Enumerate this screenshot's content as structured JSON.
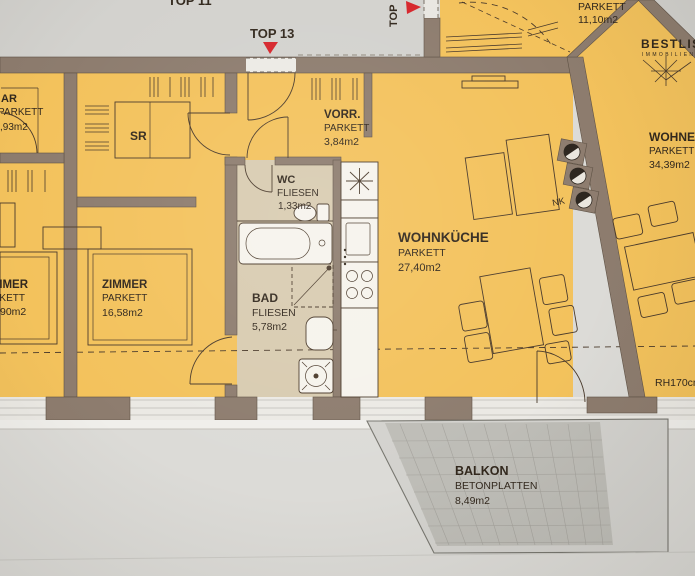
{
  "watermark": {
    "brand": "BESTLIST",
    "sub": "IMMOBILIEN"
  },
  "corridor": {
    "top11": "TOP 11",
    "top13": "TOP 13",
    "top_side": "TOP"
  },
  "rooms": {
    "ar": {
      "name": "AR",
      "floor": "PARKETT",
      "area": ",93m2"
    },
    "sr": {
      "name": "SR"
    },
    "vorr": {
      "name": "VORR.",
      "floor": "PARKETT",
      "area": "3,84m2"
    },
    "wc": {
      "name": "WC",
      "floor": "FLIESEN",
      "area": "1,33m2"
    },
    "bad": {
      "name": "BAD",
      "floor": "FLIESEN",
      "area": "5,78m2"
    },
    "zimmer_left": {
      "name": "ZIMMER",
      "floor": "PARKETT",
      "area": "90m2"
    },
    "zimmer": {
      "name": "ZIMMER",
      "floor": "PARKETT",
      "area": "16,58m2"
    },
    "wohnkueche": {
      "name": "WOHNKÜCHE",
      "floor": "PARKETT",
      "area": "27,40m2"
    },
    "wohnen": {
      "name": "WOHNEN",
      "floor": "PARKETT",
      "area": "34,39m2"
    },
    "neighbor": {
      "floor": "PARKETT",
      "area": "11,10m2"
    },
    "balkon": {
      "name": "BALKON",
      "floor": "BETONPLATTEN",
      "area": "8,49m2"
    }
  },
  "annotations": {
    "parapet": "RH170cm",
    "shaft": "NK"
  },
  "colors": {
    "room_yellow": "#f3c25c",
    "tile_beige": "#d8cbb0",
    "wall_brown": "#8d7c6e",
    "marker_red": "#d6252b",
    "balcony_grey": "#b9b7b1",
    "paper_grey": "#d9d8d4"
  }
}
